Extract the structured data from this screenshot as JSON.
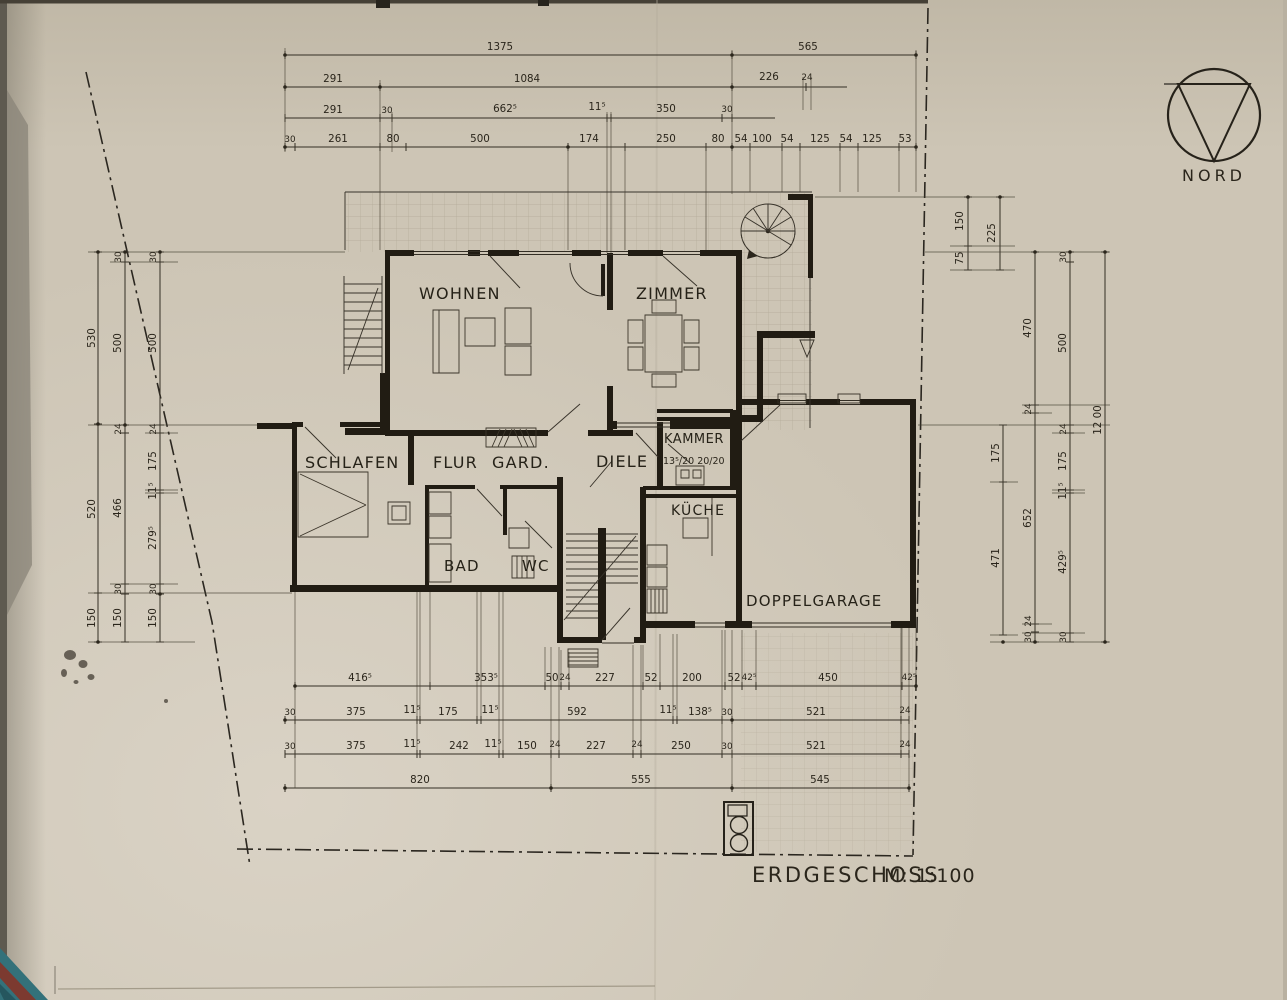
{
  "sheet": {
    "title": "ERDGESCHOSS",
    "scale": "M: 1:100",
    "north_label": "NORD"
  },
  "rooms": {
    "wohnen": "WOHNEN",
    "zimmer": "ZIMMER",
    "schlafen": "SCHLAFEN",
    "flur": "FLUR",
    "gard": "GARD.",
    "diele": "DIELE",
    "kammer": "KAMMER",
    "kammer_note": "13⁵/20  20/20",
    "kueche": "KÜCHE",
    "bad": "BAD",
    "wc": "WC",
    "garage": "DOPPELGARAGE"
  },
  "dims": {
    "top": {
      "r1": [
        "1375",
        "565"
      ],
      "r2": [
        "291",
        "1084",
        "226",
        "24"
      ],
      "r3": [
        "291",
        "30",
        "662⁵",
        "11⁵",
        "350",
        "30"
      ],
      "r4": [
        "30",
        "261",
        "80",
        "500",
        "174",
        "250",
        "80",
        "54",
        "100",
        "54",
        "125",
        "54",
        "125",
        "53"
      ]
    },
    "bottom": {
      "r1": [
        "416⁵",
        "353⁵",
        "50",
        "24",
        "227",
        "52",
        "200",
        "52",
        "42⁵",
        "450",
        "42⁵"
      ],
      "r2": [
        "30",
        "375",
        "11⁵",
        "175",
        "11⁵",
        "592",
        "11⁵",
        "138⁵",
        "30",
        "521",
        "24"
      ],
      "r3": [
        "30",
        "375",
        "11⁵",
        "242",
        "11⁵",
        "150",
        "24",
        "227",
        "24",
        "250",
        "30",
        "521",
        "24"
      ],
      "r4": [
        "820",
        "555",
        "545"
      ]
    },
    "left": {
      "c1": [
        "530",
        "520",
        "150"
      ],
      "c2": [
        "30",
        "500",
        "24",
        "466",
        "30",
        "150"
      ],
      "c3": [
        "30",
        "500",
        "24",
        "175",
        "11⁵",
        "279⁵",
        "30",
        "150"
      ]
    },
    "right": {
      "c0": [
        "150",
        "75",
        "225"
      ],
      "c1": [
        "175",
        "471"
      ],
      "c2": [
        "470",
        "24",
        "652",
        "24",
        "30"
      ],
      "c3": [
        "30",
        "500",
        "24",
        "175",
        "11⁵",
        "429⁵",
        "30"
      ],
      "c4": [
        "12 00"
      ]
    }
  }
}
